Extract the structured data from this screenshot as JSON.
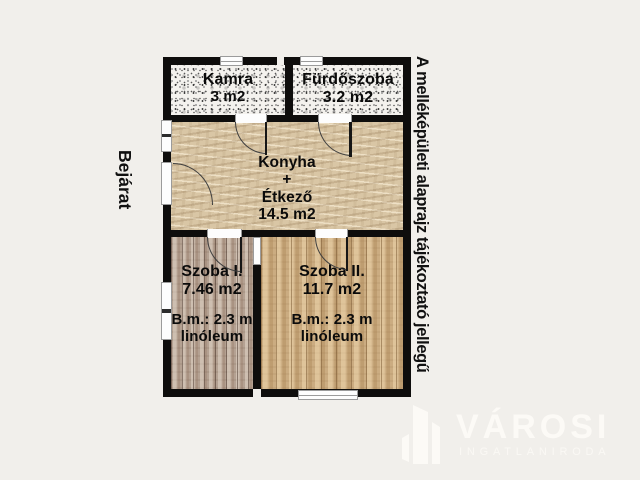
{
  "colors": {
    "background": "#f1efeb",
    "wall": "#0e0d0c",
    "window_fill": "#fdfdfd",
    "window_frame": "#9b9b9b",
    "label_text": "#0b0b0b",
    "watermark": "#fcfaf6",
    "kamra_floor_base": "#f4f2ee",
    "konyha_floor_base": "#d9c6a5",
    "szoba1_floor_base": "#b4a192",
    "szoba2_floor_base": "#cbac81"
  },
  "labels": {
    "entrance": "Bejárat",
    "disclaimer": "A melléképületi alaprajz tájékoztató jellegű"
  },
  "rooms": {
    "kamra": {
      "name": "Kamra",
      "area": "3 m2"
    },
    "furdoszoba": {
      "name": "Fürdőszoba",
      "area": "3.2 m2"
    },
    "konyha": {
      "name": "Konyha",
      "plus": "+",
      "name2": "Étkező",
      "area": "14.5 m2"
    },
    "szoba1": {
      "name": "Szoba I.",
      "area": "7.46 m2",
      "ceiling": "B.m.: 2.3 m",
      "floor": "linóleum"
    },
    "szoba2": {
      "name": "Szoba II.",
      "area": "11.7 m2",
      "ceiling": "B.m.: 2.3 m",
      "floor": "linóleum"
    }
  },
  "watermark": {
    "brand": "VÁROSI",
    "subtitle": "INGATLANIRODA"
  }
}
